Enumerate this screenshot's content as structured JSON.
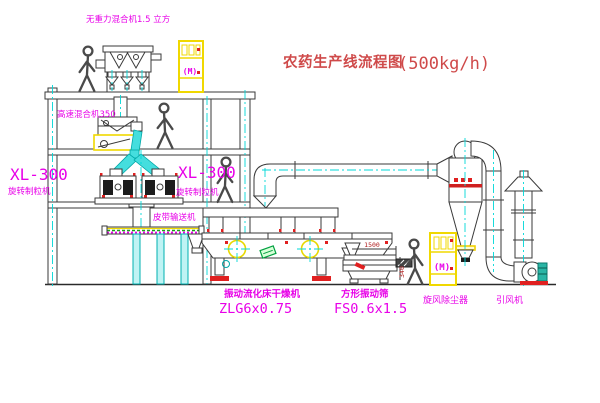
{
  "title": {
    "cn": "农药生产线流程图",
    "capacity": "(500kg/h)"
  },
  "labels": {
    "gravity_mixer": "无重力混合机1.5 立方",
    "high_speed_mixer": "高速混合机350",
    "granulator_left_model": "XL-300",
    "granulator_left_name": "旋转制粒机",
    "granulator_center_model": "XL-300",
    "granulator_center_name": "旋转制粒机",
    "belt_conveyor": "皮带输送机",
    "dryer_name": "振动流化床干燥机",
    "dryer_model": "ZLG6x0.75",
    "sieve_name": "方形振动筛",
    "sieve_model": "FS0.6x1.5",
    "cyclone_collector": "旋风除尘器",
    "induced_fan": "引风机",
    "control_cabinet_glyph": "(M)"
  },
  "dimensions": {
    "sieve_length": "1500",
    "sieve_height": "340"
  },
  "colors": {
    "line": "#3a3a3a",
    "centerline_cyan": "#00d8d8",
    "label_magenta": "#e800e8",
    "title_red": "#cf4a4a",
    "accent_red": "#e02020",
    "cabinet_yellow": "#f0d800",
    "motor_teal": "#2ab5a5",
    "conveyor_green": "#18a018"
  }
}
